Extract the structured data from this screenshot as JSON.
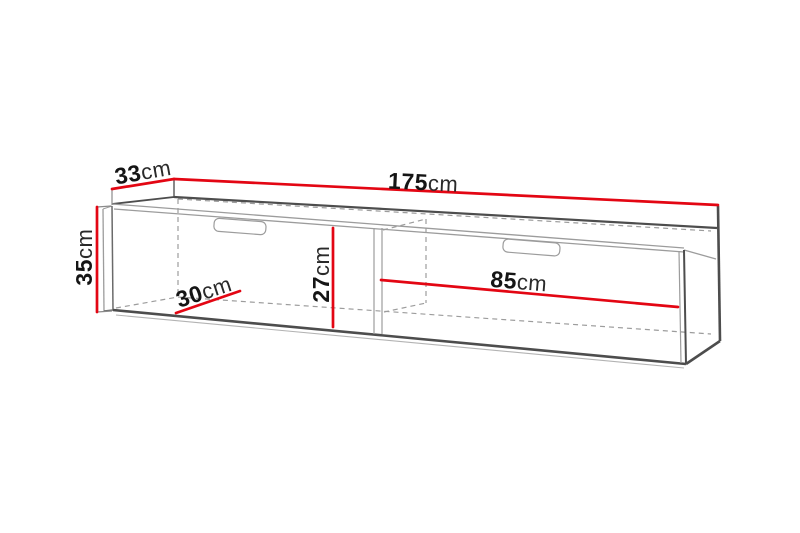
{
  "diagram": {
    "type": "furniture-dimension-diagram",
    "subject": "wall-mounted TV cabinet line drawing with dimension lines",
    "unit": "cm",
    "dimensions": {
      "width": {
        "value": "175",
        "unit": "cm"
      },
      "depth": {
        "value": "33",
        "unit": "cm"
      },
      "height": {
        "value": "35",
        "unit": "cm"
      },
      "inner_height": {
        "value": "27",
        "unit": "cm"
      },
      "inner_depth": {
        "value": "30",
        "unit": "cm"
      },
      "inner_width": {
        "value": "85",
        "unit": "cm"
      }
    },
    "colors": {
      "dimension_line": "#e30613",
      "outline_dark": "#4d4d4d",
      "outline_light": "#9c9c9c",
      "hidden_line": "#9c9c9c",
      "text": "#151515",
      "background": "#ffffff"
    }
  }
}
